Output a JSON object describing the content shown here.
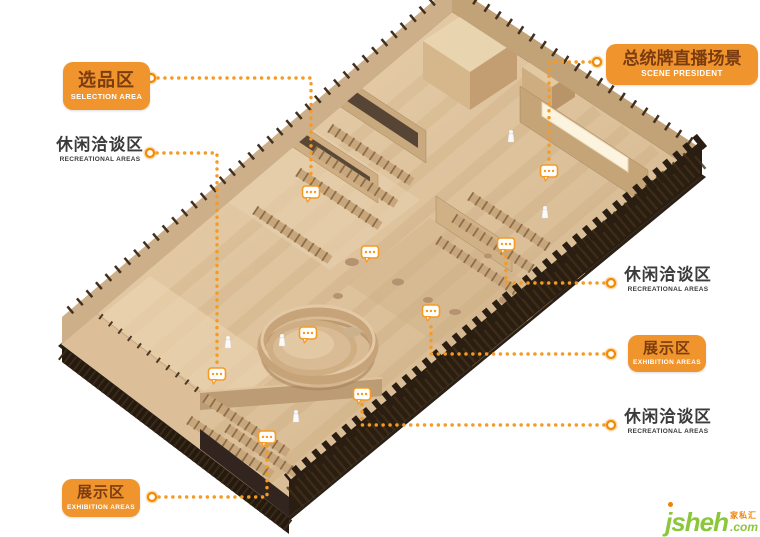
{
  "colors": {
    "accent_orange": "#F0942D",
    "leader_dot_orange": "#F59A23",
    "box_text_brown": "#7B3C10",
    "box_text_white": "#FFFFFF",
    "plain_label_text": "#3B3B3B",
    "logo_green": "#8CC63C",
    "logo_orange": "#F08300",
    "wood_light": "#E7CFAB",
    "wood_mid": "#D2B288",
    "wood_dark_edge": "#2A1D12"
  },
  "labels": [
    {
      "id": "selection-area",
      "style": "box",
      "zh": "选品区",
      "en": "SELECTION AREA"
    },
    {
      "id": "recreational-left",
      "style": "plain",
      "zh": "休闲洽谈区",
      "en": "RECREATIONAL AREAS"
    },
    {
      "id": "scene-president",
      "style": "box",
      "zh": "总统牌直播场景",
      "en": "SCENE PRESIDENT"
    },
    {
      "id": "recreational-right-upper",
      "style": "plain",
      "zh": "休闲洽谈区",
      "en": "RECREATIONAL AREAS"
    },
    {
      "id": "exhibition-right",
      "style": "box",
      "zh": "展示区",
      "en": "EXHIBITION AREAS"
    },
    {
      "id": "recreational-right-lower",
      "style": "plain",
      "zh": "休闲洽谈区",
      "en": "RECREATIONAL AREAS"
    },
    {
      "id": "exhibition-bottom",
      "style": "box",
      "zh": "展示区",
      "en": "EXHIBITION AREAS"
    }
  ],
  "watermark": {
    "latin": "jsheh",
    "cn": "家私汇",
    "tld": ".com"
  }
}
